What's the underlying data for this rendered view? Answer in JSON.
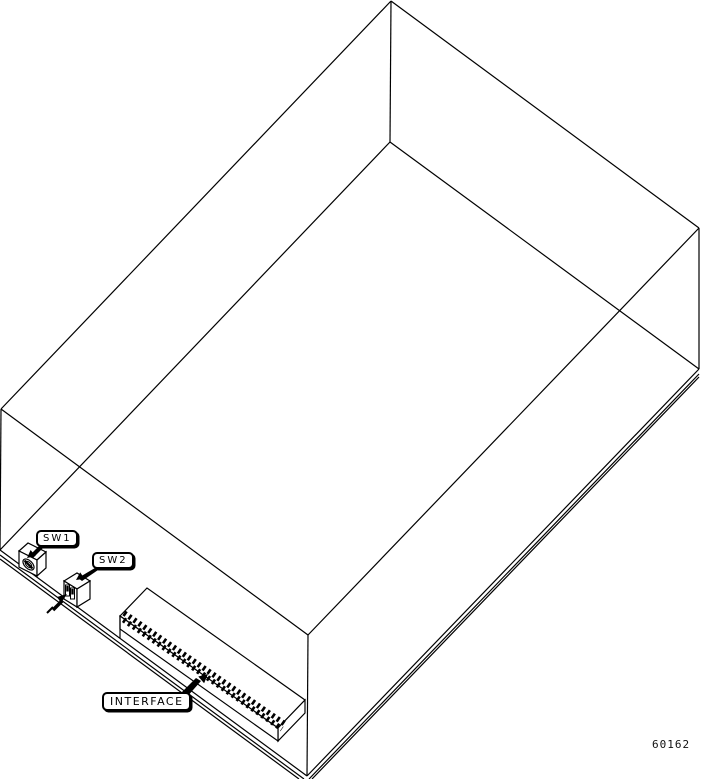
{
  "figure": {
    "description": "Isometric wireframe line drawing of an equipment enclosure showing switch and connector locations",
    "background": "#ffffff",
    "line_color": "#000000",
    "callouts": {
      "sw1": "SW1",
      "sw2": "SW2",
      "interface": "INTERFACE"
    },
    "figure_number": "60162"
  }
}
